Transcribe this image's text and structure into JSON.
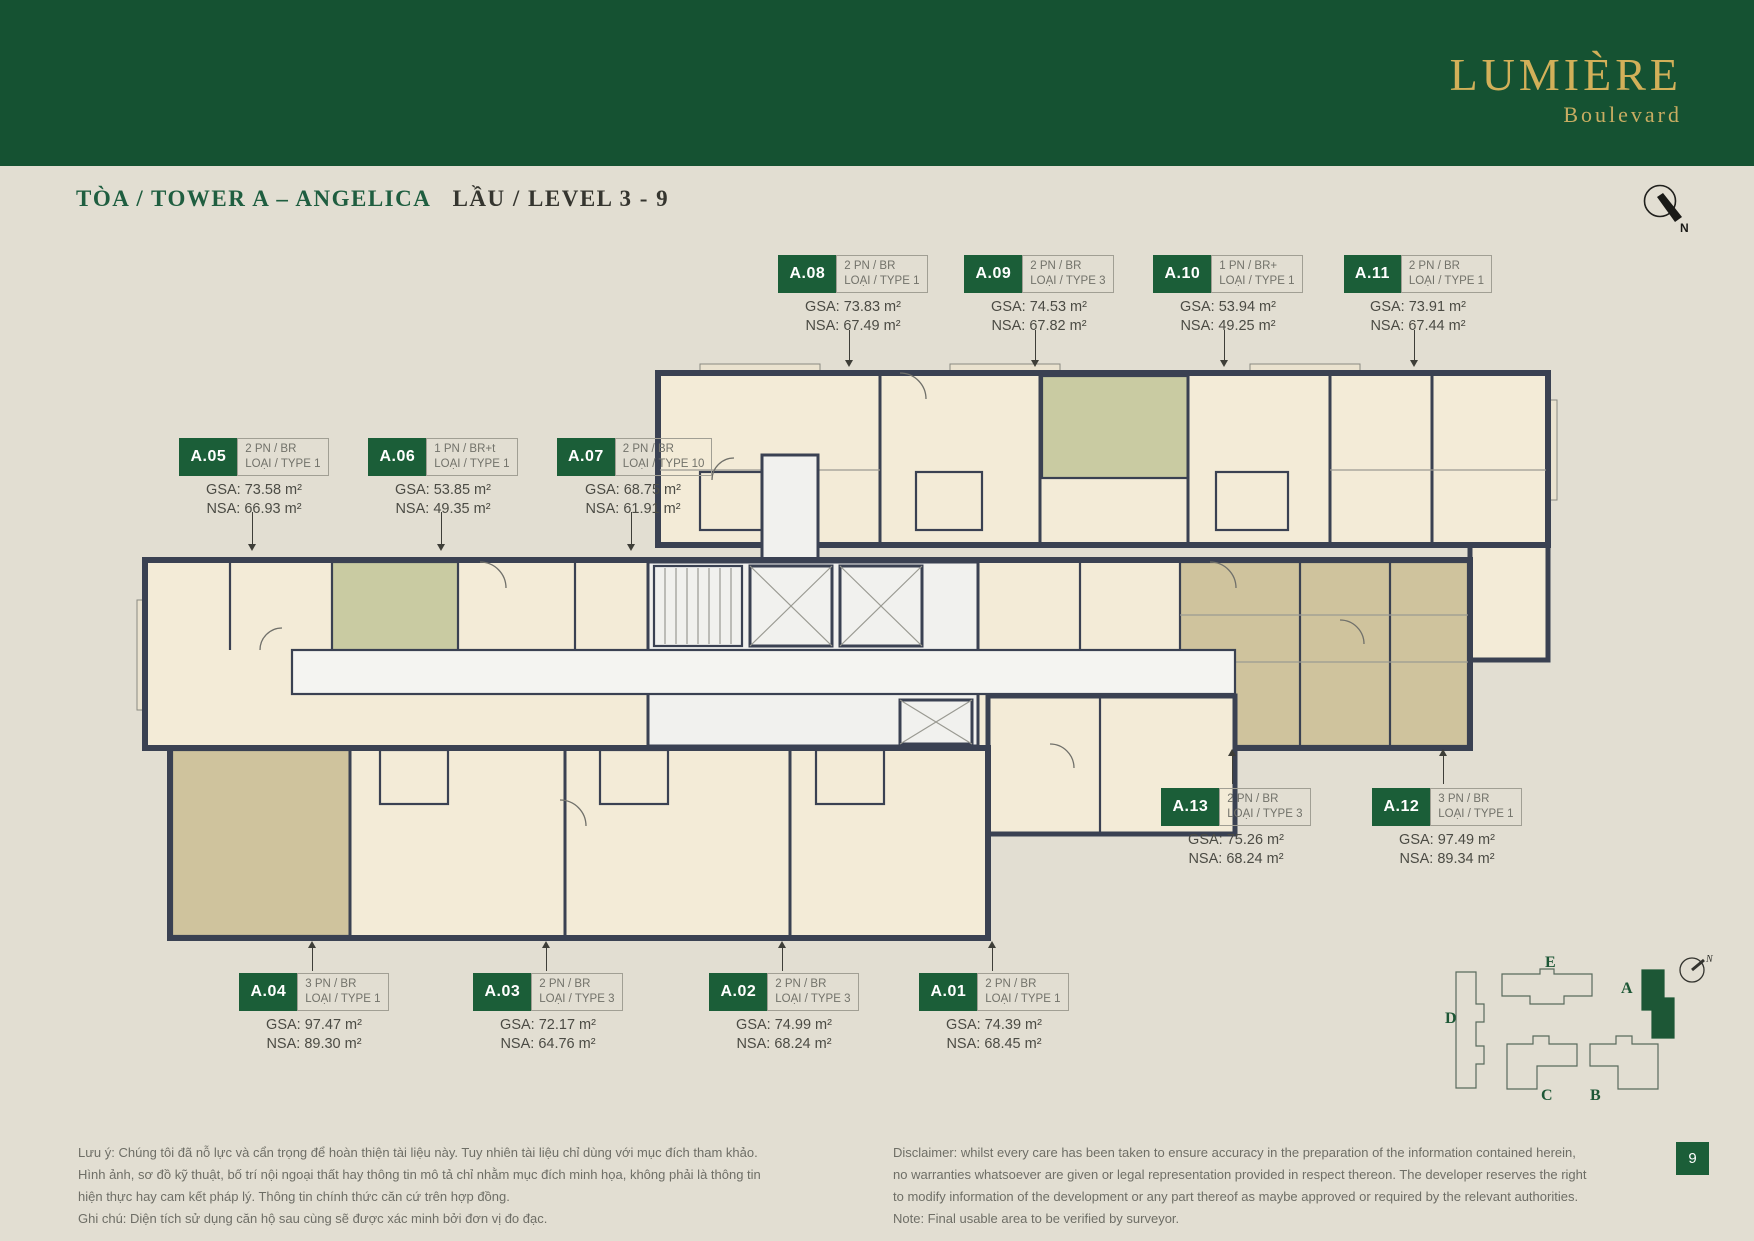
{
  "brand": {
    "name": "LUMIÈRE",
    "sub": "Boulevard"
  },
  "header": {
    "title_green": "TÒA / TOWER A – ANGELICA",
    "title_dark": "LẦU / LEVEL 3 - 9"
  },
  "compass": {
    "label": "N"
  },
  "units": [
    {
      "id": "A.01",
      "type": "2 PN / BR",
      "loai": "LOẠI / TYPE 1",
      "gsa": "GSA: 74.39 m²",
      "nsa": "NSA: 68.45 m²"
    },
    {
      "id": "A.02",
      "type": "2 PN / BR",
      "loai": "LOẠI / TYPE 3",
      "gsa": "GSA: 74.99 m²",
      "nsa": "NSA: 68.24 m²"
    },
    {
      "id": "A.03",
      "type": "2 PN / BR",
      "loai": "LOẠI / TYPE 3",
      "gsa": "GSA: 72.17 m²",
      "nsa": "NSA: 64.76 m²"
    },
    {
      "id": "A.04",
      "type": "3 PN / BR",
      "loai": "LOẠI / TYPE 1",
      "gsa": "GSA: 97.47 m²",
      "nsa": "NSA: 89.30 m²"
    },
    {
      "id": "A.05",
      "type": "2 PN / BR",
      "loai": "LOẠI / TYPE 1",
      "gsa": "GSA: 73.58 m²",
      "nsa": "NSA: 66.93 m²"
    },
    {
      "id": "A.06",
      "type": "1 PN / BR+t",
      "loai": "LOẠI / TYPE 1",
      "gsa": "GSA: 53.85 m²",
      "nsa": "NSA: 49.35 m²"
    },
    {
      "id": "A.07",
      "type": "2 PN / BR",
      "loai": "LOẠI / TYPE 10",
      "gsa": "GSA: 68.75 m²",
      "nsa": "NSA: 61.91 m²"
    },
    {
      "id": "A.08",
      "type": "2 PN / BR",
      "loai": "LOẠI / TYPE 1",
      "gsa": "GSA: 73.83 m²",
      "nsa": "NSA: 67.49 m²"
    },
    {
      "id": "A.09",
      "type": "2 PN / BR",
      "loai": "LOẠI / TYPE 3",
      "gsa": "GSA: 74.53 m²",
      "nsa": "NSA: 67.82 m²"
    },
    {
      "id": "A.10",
      "type": "1 PN / BR+",
      "loai": "LOẠI / TYPE 1",
      "gsa": "GSA: 53.94 m²",
      "nsa": "NSA: 49.25 m²"
    },
    {
      "id": "A.11",
      "type": "2 PN / BR",
      "loai": "LOẠI / TYPE 1",
      "gsa": "GSA: 73.91 m²",
      "nsa": "NSA: 67.44 m²"
    },
    {
      "id": "A.12",
      "type": "3 PN / BR",
      "loai": "LOẠI / TYPE 1",
      "gsa": "GSA: 97.49 m²",
      "nsa": "NSA: 89.34 m²"
    },
    {
      "id": "A.13",
      "type": "2 PN / BR",
      "loai": "LOẠI / TYPE 3",
      "gsa": "GSA: 75.26 m²",
      "nsa": "NSA: 68.24 m²"
    }
  ],
  "keyplan": {
    "towers": [
      "A",
      "B",
      "C",
      "D",
      "E"
    ]
  },
  "notes": {
    "vi": "Lưu ý: Chúng tôi đã nỗ lực và cẩn trọng để hoàn thiện tài liệu này. Tuy nhiên tài liệu chỉ dùng với mục đích tham khảo. Hình ảnh, sơ đồ kỹ thuật, bố trí nội ngoại thất hay thông tin mô tả chỉ nhằm mục đích minh họa, không phải là thông tin hiện thực hay cam kết pháp lý. Thông tin chính thức căn cứ trên hợp đồng.",
    "vi_note": "Ghi chú: Diện tích sử dụng căn hộ sau cùng sẽ được xác minh bởi đơn vị đo đạc.",
    "en": "Disclaimer: whilst every care has been taken to ensure accuracy in the preparation of the information contained herein, no warranties whatsoever are given or legal representation provided in respect thereon. The developer reserves the right to modify information of the development or any part thereof as maybe approved or required by the relevant authorities.",
    "en_note": "Note: Final usable area to be verified by surveyor."
  },
  "page_number": "9",
  "colors": {
    "banner_green": "#155232",
    "unit_box_green": "#1b5e38",
    "gold": "#d2b059",
    "page_bg": "#e2ded2",
    "wall": "#3a4152",
    "room_cream": "#f3ebd7",
    "room_olive": "#c9cba2",
    "room_tan": "#cfc39d"
  }
}
